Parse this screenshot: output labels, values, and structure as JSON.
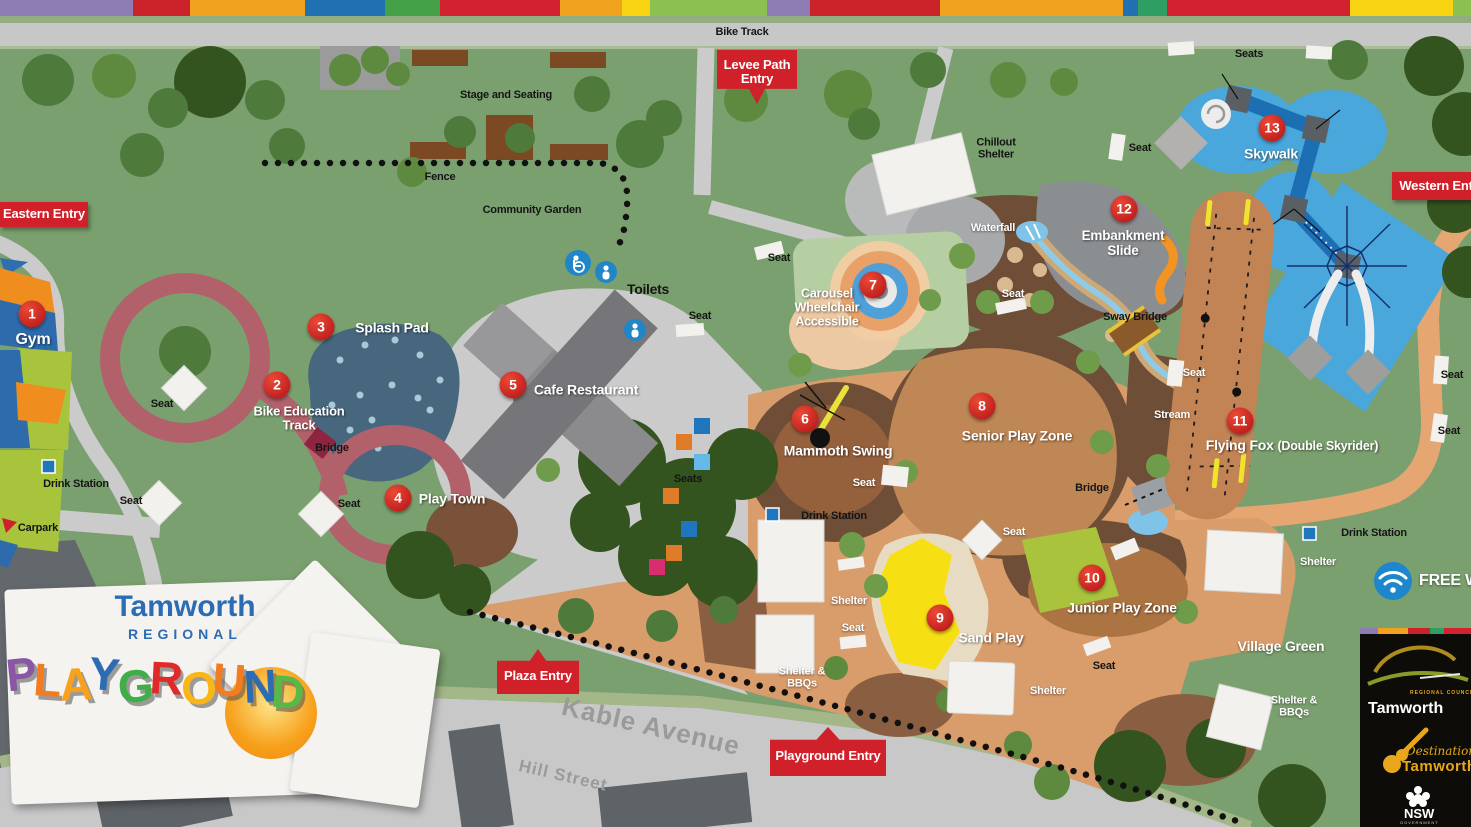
{
  "title": "Tamworth Regional Playground Map",
  "stripe_colors": [
    "#8d7bb4",
    "#cb2229",
    "#f0a11d",
    "#2170b2",
    "#44a147",
    "#d22230",
    "#f0a11d",
    "#f8d312",
    "#8cc051",
    "#8d7bb4",
    "#cb2229",
    "#f0a11d",
    "#2170b2",
    "#2f9e63",
    "#d22230",
    "#f8d312",
    "#8cc051"
  ],
  "roads": {
    "bike_track": "Bike Track",
    "kable_avenue": "Kable Avenue",
    "hill_street": "Hill Street"
  },
  "entries": {
    "eastern": "Eastern Entry",
    "levee": "Levee Path Entry",
    "western": "Western Entry",
    "plaza": "Plaza Entry",
    "playground": "Playground Entry"
  },
  "points": [
    {
      "num": "1",
      "label": "Gym"
    },
    {
      "num": "2",
      "label": "Bike Education Track"
    },
    {
      "num": "3",
      "label": "Splash Pad"
    },
    {
      "num": "4",
      "label": "Play Town"
    },
    {
      "num": "5",
      "label": "Cafe Restaurant"
    },
    {
      "num": "6",
      "label": "Mammoth Swing"
    },
    {
      "num": "7",
      "label": "Carousel Wheelchair Accessible"
    },
    {
      "num": "8",
      "label": "Senior Play Zone"
    },
    {
      "num": "9",
      "label": "Sand Play"
    },
    {
      "num": "10",
      "label": "Junior Play Zone"
    },
    {
      "num": "11",
      "label": "Flying Fox",
      "sublabel": "(Double Skyrider)"
    },
    {
      "num": "12",
      "label": "Embankment Slide"
    },
    {
      "num": "13",
      "label": "Skywalk"
    }
  ],
  "labels": {
    "stage": "Stage and Seating",
    "fence": "Fence",
    "community_garden": "Community Garden",
    "toilets": "Toilets",
    "chillout": "Chillout Shelter",
    "waterfall": "Waterfall",
    "sway_bridge": "Sway Bridge",
    "stream": "Stream",
    "bridge": "Bridge",
    "village_green": "Village Green",
    "carpark": "Carpark",
    "drink_station": "Drink Station",
    "seat": "Seat",
    "seats": "Seats",
    "shelter": "Shelter",
    "shelter_bbqs": "Shelter & BBQs",
    "free_wifi": "FREE WIFI"
  },
  "logo": {
    "line1": "Tamworth",
    "line2": "REGIONAL",
    "letters": [
      {
        "ch": "P",
        "color": "#8a56a5"
      },
      {
        "ch": "L",
        "color": "#f47b20"
      },
      {
        "ch": "A",
        "color": "#f9a11b"
      },
      {
        "ch": "Y",
        "color": "#2b6cb5"
      },
      {
        "ch": "G",
        "color": "#3fae49"
      },
      {
        "ch": "R",
        "color": "#e02a2a"
      },
      {
        "ch": "O",
        "color": "#f9b616"
      },
      {
        "ch": "U",
        "color": "#f47b20"
      },
      {
        "ch": "N",
        "color": "#2b6cb5"
      },
      {
        "ch": "D",
        "color": "#59b947"
      }
    ]
  },
  "brand": {
    "council": "Tamworth",
    "council_tag": "REGIONAL COUNCIL",
    "dest_script": "Destination",
    "dest_name": "Tamworth",
    "gov": "NSW",
    "gov_sub": "GOVERNMENT"
  }
}
